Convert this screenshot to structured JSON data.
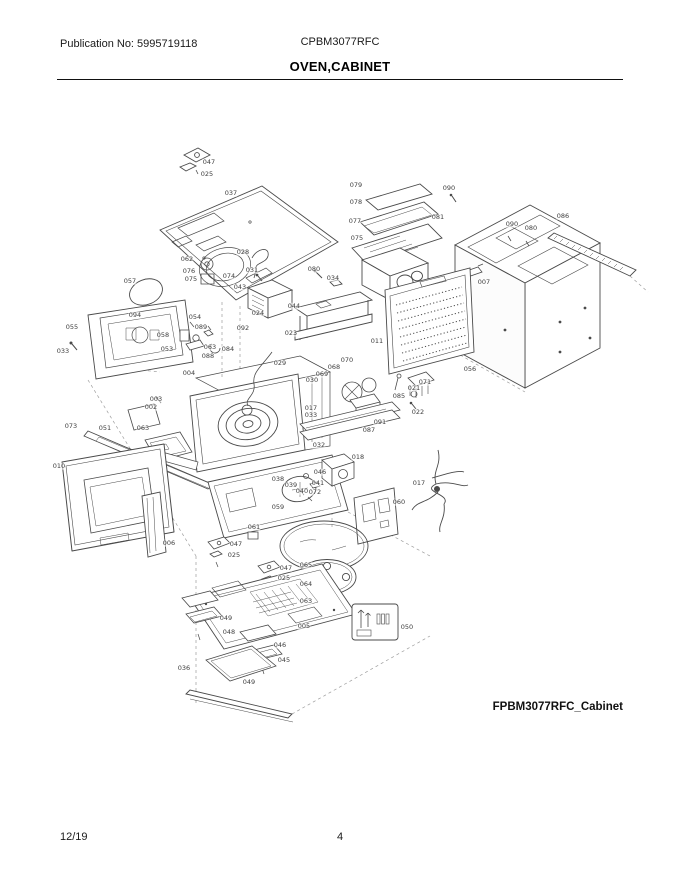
{
  "header": {
    "publication_label": "Publication No: 5995719118",
    "model": "CPBM3077RFC",
    "title": "OVEN,CABINET"
  },
  "diagram": {
    "caption": "FPBM3077RFC_Cabinet",
    "description": "Exploded parts view of microwave oven cabinet assembly",
    "callouts": [
      {
        "label": "047",
        "x": 209,
        "y": 162
      },
      {
        "label": "025",
        "x": 207,
        "y": 174
      },
      {
        "label": "037",
        "x": 231,
        "y": 193
      },
      {
        "label": "062",
        "x": 187,
        "y": 259
      },
      {
        "label": "028",
        "x": 243,
        "y": 252
      },
      {
        "label": "076",
        "x": 189,
        "y": 271
      },
      {
        "label": "075",
        "x": 191,
        "y": 279
      },
      {
        "label": "074",
        "x": 229,
        "y": 276
      },
      {
        "label": "057",
        "x": 130,
        "y": 281
      },
      {
        "label": "094",
        "x": 135,
        "y": 315
      },
      {
        "label": "055",
        "x": 72,
        "y": 327
      },
      {
        "label": "033",
        "x": 63,
        "y": 351
      },
      {
        "label": "058",
        "x": 163,
        "y": 335
      },
      {
        "label": "054",
        "x": 195,
        "y": 317
      },
      {
        "label": "089",
        "x": 201,
        "y": 327
      },
      {
        "label": "053",
        "x": 167,
        "y": 349
      },
      {
        "label": "063",
        "x": 210,
        "y": 347
      },
      {
        "label": "088",
        "x": 208,
        "y": 356
      },
      {
        "label": "084",
        "x": 228,
        "y": 349
      },
      {
        "label": "004",
        "x": 189,
        "y": 373
      },
      {
        "label": "079",
        "x": 356,
        "y": 185
      },
      {
        "label": "078",
        "x": 356,
        "y": 202
      },
      {
        "label": "077",
        "x": 355,
        "y": 221
      },
      {
        "label": "075",
        "x": 357,
        "y": 238
      },
      {
        "label": "090",
        "x": 449,
        "y": 188
      },
      {
        "label": "081",
        "x": 438,
        "y": 217
      },
      {
        "label": "086",
        "x": 563,
        "y": 216
      },
      {
        "label": "090",
        "x": 512,
        "y": 224
      },
      {
        "label": "080",
        "x": 531,
        "y": 228
      },
      {
        "label": "007",
        "x": 484,
        "y": 282
      },
      {
        "label": "056",
        "x": 470,
        "y": 369
      },
      {
        "label": "031",
        "x": 252,
        "y": 270
      },
      {
        "label": "043",
        "x": 240,
        "y": 287
      },
      {
        "label": "080",
        "x": 314,
        "y": 269
      },
      {
        "label": "034",
        "x": 333,
        "y": 278
      },
      {
        "label": "044",
        "x": 294,
        "y": 306
      },
      {
        "label": "024",
        "x": 258,
        "y": 313
      },
      {
        "label": "023",
        "x": 291,
        "y": 333
      },
      {
        "label": "092",
        "x": 243,
        "y": 328
      },
      {
        "label": "011",
        "x": 377,
        "y": 341
      },
      {
        "label": "029",
        "x": 280,
        "y": 363
      },
      {
        "label": "070",
        "x": 347,
        "y": 360
      },
      {
        "label": "068",
        "x": 334,
        "y": 367
      },
      {
        "label": "069",
        "x": 322,
        "y": 374
      },
      {
        "label": "030",
        "x": 312,
        "y": 380
      },
      {
        "label": "071",
        "x": 425,
        "y": 382
      },
      {
        "label": "021",
        "x": 414,
        "y": 388
      },
      {
        "label": "085",
        "x": 399,
        "y": 396
      },
      {
        "label": "022",
        "x": 418,
        "y": 412
      },
      {
        "label": "091",
        "x": 380,
        "y": 422
      },
      {
        "label": "087",
        "x": 369,
        "y": 430
      },
      {
        "label": "017",
        "x": 311,
        "y": 408
      },
      {
        "label": "033",
        "x": 311,
        "y": 415
      },
      {
        "label": "032",
        "x": 319,
        "y": 445
      },
      {
        "label": "018",
        "x": 358,
        "y": 457
      },
      {
        "label": "003",
        "x": 156,
        "y": 399
      },
      {
        "label": "002",
        "x": 151,
        "y": 407
      },
      {
        "label": "073",
        "x": 71,
        "y": 426
      },
      {
        "label": "051",
        "x": 105,
        "y": 428
      },
      {
        "label": "063",
        "x": 143,
        "y": 428
      },
      {
        "label": "010",
        "x": 59,
        "y": 466
      },
      {
        "label": "006",
        "x": 169,
        "y": 543
      },
      {
        "label": "059",
        "x": 278,
        "y": 507
      },
      {
        "label": "061",
        "x": 254,
        "y": 527
      },
      {
        "label": "047",
        "x": 236,
        "y": 544
      },
      {
        "label": "025",
        "x": 234,
        "y": 555
      },
      {
        "label": "047",
        "x": 286,
        "y": 568
      },
      {
        "label": "025",
        "x": 284,
        "y": 578
      },
      {
        "label": "038",
        "x": 278,
        "y": 479
      },
      {
        "label": "039",
        "x": 291,
        "y": 485
      },
      {
        "label": "040",
        "x": 302,
        "y": 491
      },
      {
        "label": "046",
        "x": 320,
        "y": 472
      },
      {
        "label": "041",
        "x": 318,
        "y": 483
      },
      {
        "label": "072",
        "x": 315,
        "y": 492
      },
      {
        "label": "060",
        "x": 399,
        "y": 502
      },
      {
        "label": "017",
        "x": 419,
        "y": 483
      },
      {
        "label": "065",
        "x": 306,
        "y": 565
      },
      {
        "label": "064",
        "x": 306,
        "y": 584
      },
      {
        "label": "063",
        "x": 306,
        "y": 601
      },
      {
        "label": "049",
        "x": 226,
        "y": 618
      },
      {
        "label": "048",
        "x": 229,
        "y": 632
      },
      {
        "label": "046",
        "x": 280,
        "y": 645
      },
      {
        "label": "045",
        "x": 284,
        "y": 660
      },
      {
        "label": "005",
        "x": 304,
        "y": 626
      },
      {
        "label": "036",
        "x": 184,
        "y": 668
      },
      {
        "label": "049",
        "x": 249,
        "y": 682
      },
      {
        "label": "050",
        "x": 407,
        "y": 627
      }
    ]
  },
  "footer": {
    "date": "12/19",
    "page": "4"
  }
}
